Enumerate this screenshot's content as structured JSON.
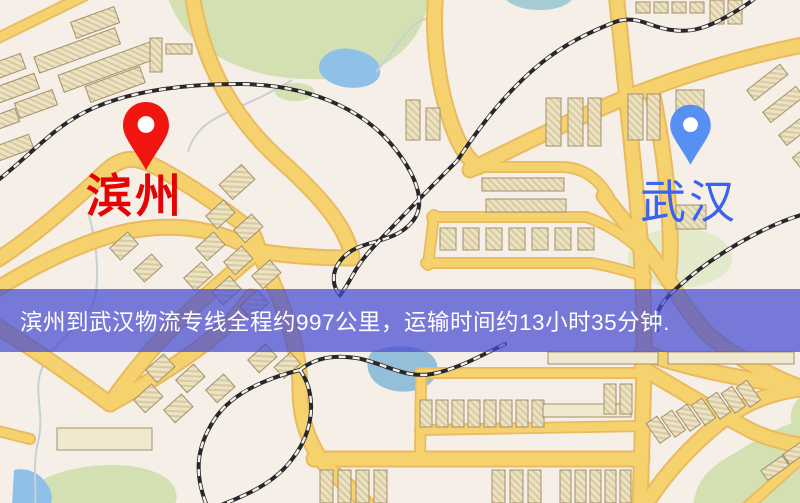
{
  "origin": {
    "name": "滨州",
    "label_color": "#e60302",
    "pin_color": "#f01511"
  },
  "destination": {
    "name": "武汉",
    "label_color": "#3c63ee",
    "pin_color": "#5590f2"
  },
  "banner": {
    "text": "滨州到武汉物流专线全程约997公里，运输时间约13小时35分钟.",
    "background_color": "rgba(70,75,211,0.72)",
    "text_color": "#ffffff"
  },
  "route": {
    "origin_city": "滨州",
    "destination_city": "武汉",
    "distance_km": "997",
    "duration_hours": "13",
    "duration_minutes": "35"
  },
  "map_palette": {
    "background": "#f5efe7",
    "road": "#f6d26e",
    "park": "#d3e1b2",
    "water": "#8fc0e8",
    "building": "#ece2c4",
    "railway": "#28282c"
  }
}
